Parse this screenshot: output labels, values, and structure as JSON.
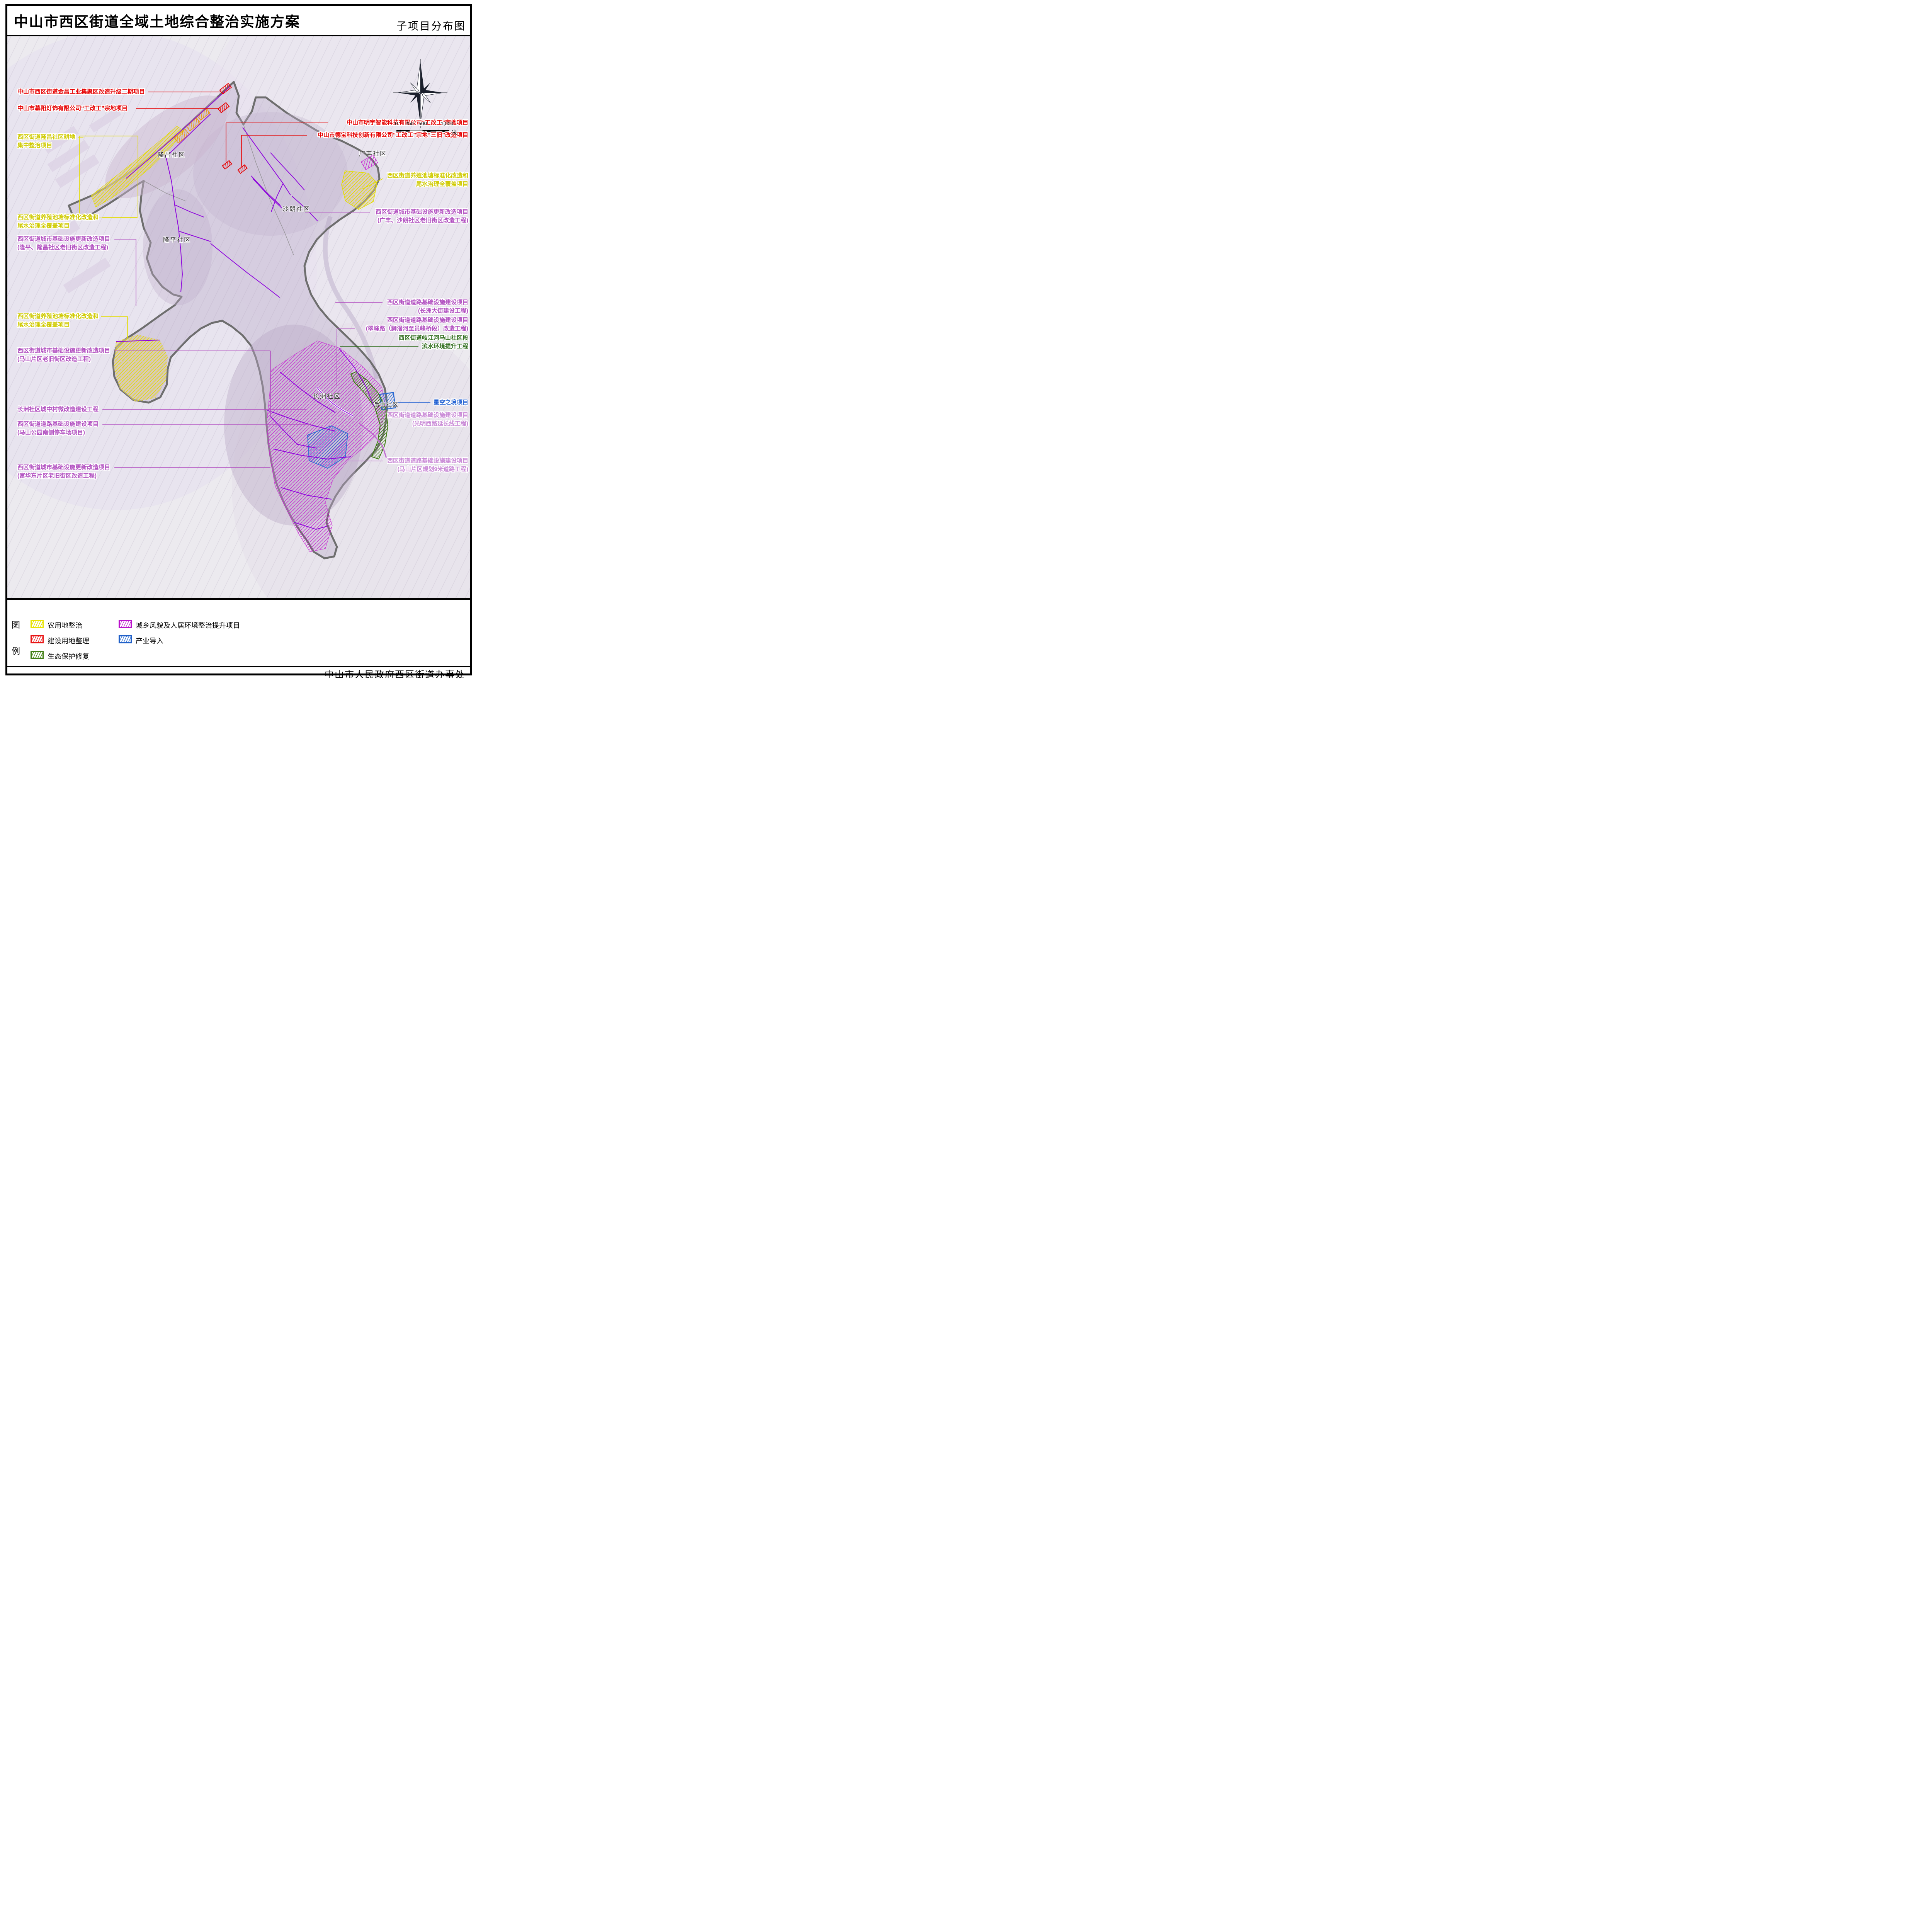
{
  "page": {
    "title": "中山市西区街道全域土地综合整治实施方案",
    "subtitle": "子项目分布图",
    "footer": "中山市人民政府西区街道办事处"
  },
  "map": {
    "communities": [
      {
        "name": "隆昌社区"
      },
      {
        "name": "广丰社区"
      },
      {
        "name": "沙朗社区"
      },
      {
        "name": "隆平社区"
      },
      {
        "name": "长洲社区"
      },
      {
        "name": "后山社区"
      }
    ],
    "labels_left": [
      {
        "line1": "中山市西区街道金昌工业集聚区改造升级二期项目",
        "line2": "",
        "color": "#e60000"
      },
      {
        "line1": "中山市慕阳灯饰有限公司“工改工”宗地项目",
        "line2": "",
        "color": "#e60000"
      },
      {
        "line1": "西区街道隆昌社区耕地",
        "line2": "集中整治项目",
        "color": "#cfca00"
      },
      {
        "line1": "西区街道养殖池塘标准化改造和",
        "line2": "尾水治理全覆盖项目",
        "color": "#cfca00"
      },
      {
        "line1": "西区街道城市基础设施更新改造项目",
        "line2": "(隆平、隆昌社区老旧街区改造工程)",
        "color": "#b14fc0"
      },
      {
        "line1": "西区街道养殖池塘标准化改造和",
        "line2": "尾水治理全覆盖项目",
        "color": "#cfca00"
      },
      {
        "line1": "西区街道城市基础设施更新改造项目",
        "line2": "(马山片区老旧街区改造工程)",
        "color": "#b14fc0"
      },
      {
        "line1": "长洲社区城中村微改造建设工程",
        "line2": "",
        "color": "#b14fc0"
      },
      {
        "line1": "西区街道道路基础设施建设项目",
        "line2": "(马山公园南侧停车场项目)",
        "color": "#b14fc0"
      },
      {
        "line1": "西区街道城市基础设施更新改造项目",
        "line2": "(富华东片区老旧街区改造工程)",
        "color": "#b14fc0"
      }
    ],
    "labels_right": [
      {
        "line1": "中山市明宇智能科技有限公司“工改工”宗地项目",
        "line2": "",
        "color": "#e60000"
      },
      {
        "line1": "中山市德宝科技创新有限公司“工改工”宗地“三旧”改造项目",
        "line2": "",
        "color": "#e60000"
      },
      {
        "line1": "西区街道养殖池塘标准化改造和",
        "line2": "尾水治理全覆盖项目",
        "color": "#cfca00"
      },
      {
        "line1": "西区街道城市基础设施更新改造项目",
        "line2": "(广丰、沙朗社区老旧街区改造工程)",
        "color": "#b14fc0"
      },
      {
        "line1": "西区街道道路基础设施建设项目",
        "line2": "(长洲大街建设工程)",
        "color": "#b14fc0"
      },
      {
        "line1": "西区街道道路基础设施建设项目",
        "line2": "(翠峰路（狮滘河至员峰桥段）改造工程)",
        "color": "#b14fc0"
      },
      {
        "line1": "西区街道岐江河马山社区段",
        "line2": "滨水环境提升工程",
        "color": "#2f6d1d"
      },
      {
        "line1": "星空之境项目",
        "line2": "",
        "color": "#1f5fd2"
      },
      {
        "line1": "西区街道道路基础设施建设项目",
        "line2": "(光明西路延长线工程)",
        "color": "#c989d6"
      },
      {
        "line1": "西区街道道路基础设施建设项目",
        "line2": "(马山片区规划9米道路工程)",
        "color": "#c989d6"
      }
    ],
    "scale_bar": {
      "ticks": [
        "0",
        "250",
        "500",
        "1,000"
      ],
      "unit": "米"
    }
  },
  "legend": {
    "title_top": "图",
    "title_bottom": "例",
    "items": [
      {
        "label": "农用地整治",
        "color": "#e8e400"
      },
      {
        "label": "建设用地整理",
        "color": "#e81414"
      },
      {
        "label": "生态保护修复",
        "color": "#3f7d14"
      },
      {
        "label": "城乡风貌及人居环境整治提升项目",
        "color": "#bb10cc"
      },
      {
        "label": "产业导入",
        "color": "#2060c8"
      }
    ]
  }
}
